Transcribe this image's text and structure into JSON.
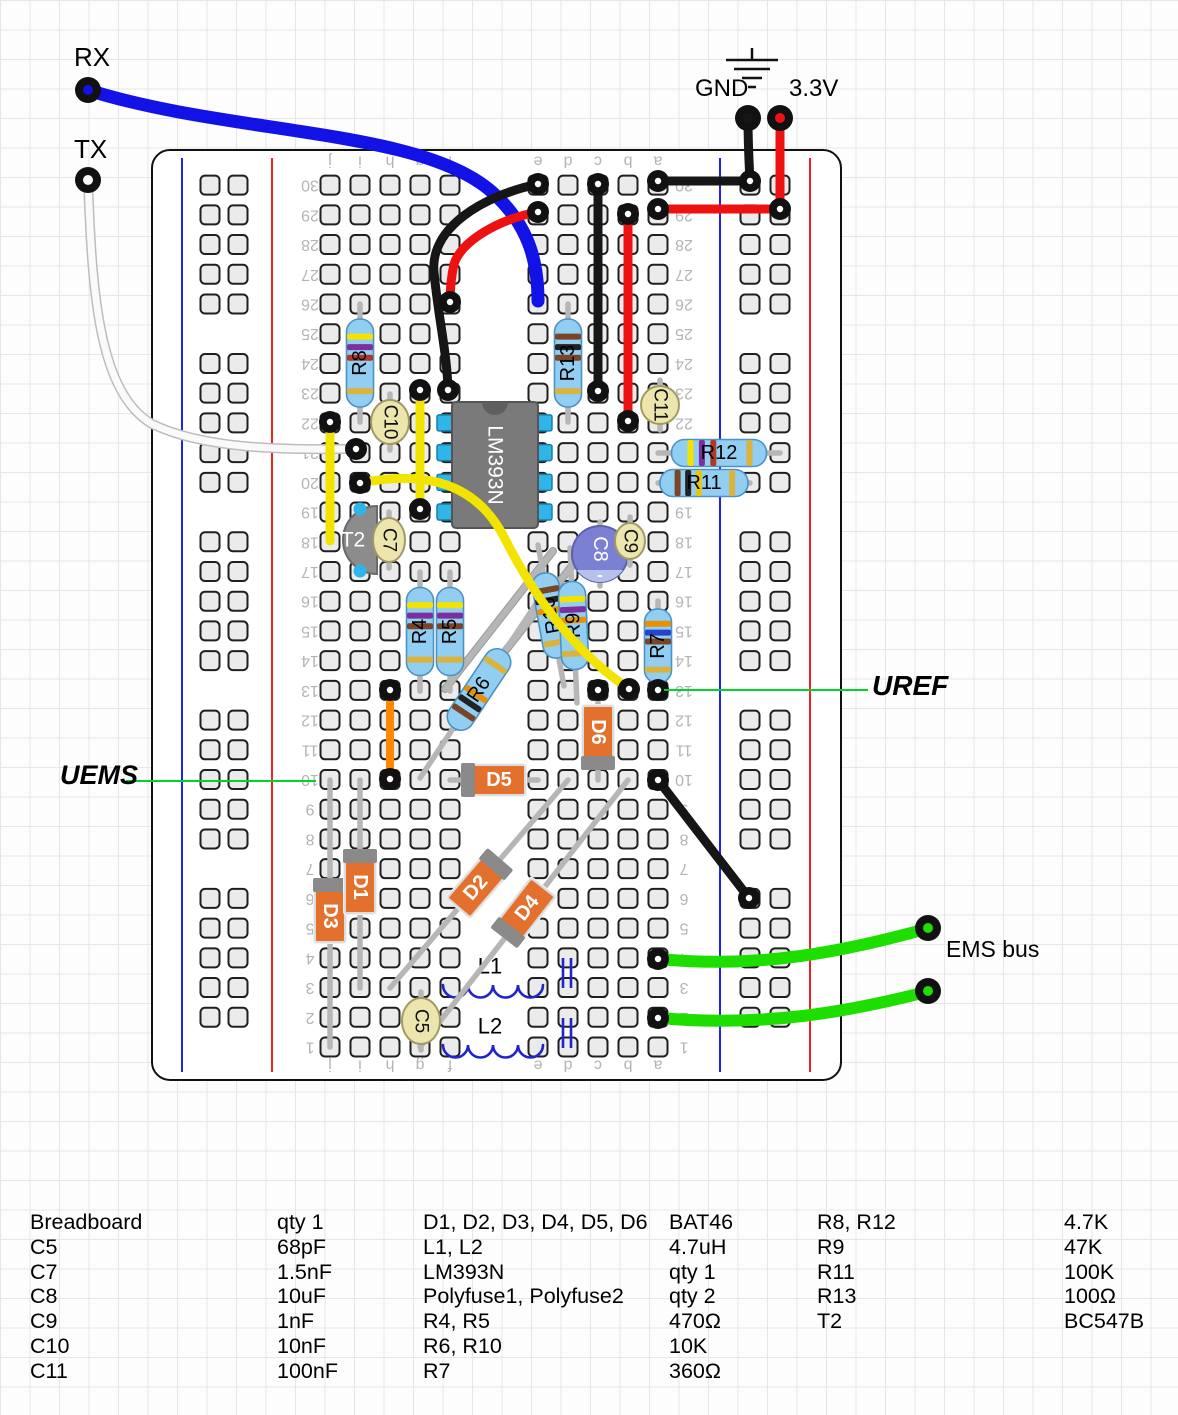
{
  "annotations": {
    "rx": "RX",
    "tx": "TX",
    "gnd": "GND",
    "v33": "3.3V",
    "uref": "UREF",
    "uems": "UEMS",
    "ems_bus": "EMS bus"
  },
  "board": {
    "x": 152,
    "y": 150,
    "w": 689,
    "h": 930,
    "rows": 30,
    "col_letters": [
      "j",
      "i",
      "h",
      "g",
      "f",
      "e",
      "d",
      "c",
      "b",
      "a"
    ],
    "col_x": [
      330,
      360,
      390,
      420,
      450,
      538,
      568,
      598,
      628,
      658
    ],
    "row_y0": 1047,
    "row_pitch": 29.72,
    "num_x_left": 310,
    "num_x_right": 684,
    "letters_y_top": 161,
    "letters_y_bottom": 1065,
    "rails": {
      "left": {
        "blue_x": 182,
        "red_x": 272,
        "hole_x": [
          210,
          238
        ]
      },
      "right": {
        "blue_x": 720,
        "red_x": 810,
        "hole_x": [
          750,
          780
        ]
      }
    },
    "hole": {
      "size": 19,
      "fill": "#ebebeb",
      "stroke": "#1f1f1f"
    },
    "label_color": "#b4b4b4"
  },
  "colors": {
    "rail_blue": "#2222ee",
    "rail_red": "#ee2222",
    "lead": "#b6b6b6",
    "resistor_body": "#92cdf2",
    "resistor_stroke": "#4b93c4",
    "diode_body": "#e4702d",
    "diode_stroke": "#dcdcdc",
    "diode_band": "#8a8a8a",
    "disc_cap": "#ece6ae",
    "disc_cap_stroke": "#a19a62",
    "elec_cap": "#7b80d2",
    "elec_cap_stroke": "#5c60b0",
    "elec_cap_stripe": "#b7c0ea",
    "ic_body": "#7a7a7a",
    "ic_stroke": "#555555",
    "ic_notch": "#5f5f5f",
    "ic_pin": "#2fb5e8",
    "ic_pin_stroke": "#1580aa",
    "transistor": "#8c8c8c",
    "transistor_stroke": "#6a6a6a",
    "inductor": "#2323cc",
    "annotation_green": "#00d42a",
    "ring": "#111111",
    "wire_map": {
      "blue": "#1212e6",
      "red": "#ee1111",
      "black": "#161616",
      "yellow": "#f2e400",
      "orange": "#ff8800",
      "green": "#1ede00",
      "white": "#fafafa"
    }
  },
  "components": [
    {
      "type": "polyfuse",
      "label": "Polyfuse1",
      "x1": 553,
      "y1": 551,
      "x2": 445,
      "y2": 689
    },
    {
      "type": "polyfuse",
      "label": "Polyfuse2",
      "x1": 571,
      "y1": 567,
      "x2": 463,
      "y2": 705
    },
    {
      "type": "inductor",
      "label": "L1",
      "x": 443,
      "y": 985,
      "w": 100,
      "lx": 490,
      "ly": 966
    },
    {
      "type": "inductor",
      "label": "L2",
      "x": 443,
      "y": 1045,
      "w": 100,
      "lx": 490,
      "ly": 1026
    },
    {
      "type": "diode",
      "label": "D3",
      "x1": 330,
      "y1": 780,
      "x2": 330,
      "y2": 1047,
      "cx": 330,
      "cy": 911,
      "bandStart": true
    },
    {
      "type": "diode",
      "label": "D1",
      "x1": 360,
      "y1": 780,
      "x2": 360,
      "y2": 988,
      "cx": 360,
      "cy": 882,
      "bandStart": true
    },
    {
      "type": "diode",
      "label": "D2",
      "x1": 390,
      "y1": 988,
      "x2": 568,
      "y2": 780,
      "cx": 479,
      "cy": 884,
      "bandStart": false
    },
    {
      "type": "diode",
      "label": "D4",
      "x1": 420,
      "y1": 1047,
      "x2": 628,
      "y2": 780,
      "cx": 524,
      "cy": 912,
      "bandStart": true
    },
    {
      "type": "diode",
      "label": "D5",
      "x1": 450,
      "y1": 780,
      "x2": 538,
      "y2": 780,
      "cx": 494,
      "cy": 780,
      "bandStart": true
    },
    {
      "type": "diode",
      "label": "D6",
      "x1": 598,
      "y1": 691,
      "x2": 598,
      "y2": 780,
      "cx": 598,
      "cy": 737,
      "bandStart": false
    },
    {
      "type": "transistor",
      "label": "T2",
      "cx": 355,
      "cy": 540
    },
    {
      "type": "resistor",
      "label": "R8",
      "x1": 360,
      "y1": 304,
      "x2": 360,
      "y2": 422,
      "bl": 88,
      "flip": true,
      "bands": [
        "#f2e400",
        "#7d2f9e",
        "#b03828"
      ]
    },
    {
      "type": "resistor",
      "label": "R13",
      "x1": 568,
      "y1": 304,
      "x2": 568,
      "y2": 422,
      "bl": 88,
      "flip": true,
      "bands": [
        "#7a4426",
        "#222222",
        "#7a4426"
      ]
    },
    {
      "type": "resistor",
      "label": "R12",
      "x1": 658,
      "y1": 453,
      "x2": 780,
      "y2": 453,
      "bl": 95,
      "flip": false,
      "bands": [
        "#f2e400",
        "#7d2f9e",
        "#b03828"
      ]
    },
    {
      "type": "resistor",
      "label": "R11",
      "x1": 658,
      "y1": 483,
      "x2": 750,
      "y2": 483,
      "bl": 88,
      "flip": false,
      "bands": [
        "#7a4426",
        "#222222",
        "#e8c800"
      ]
    },
    {
      "type": "resistor",
      "label": "R4",
      "x1": 420,
      "y1": 572,
      "x2": 420,
      "y2": 691,
      "bl": 88,
      "flip": true,
      "bands": [
        "#f2e400",
        "#7d2f9e",
        "#7a4426"
      ]
    },
    {
      "type": "resistor",
      "label": "R5",
      "x1": 450,
      "y1": 572,
      "x2": 450,
      "y2": 691,
      "bl": 88,
      "flip": true,
      "bands": [
        "#f2e400",
        "#7d2f9e",
        "#7a4426"
      ]
    },
    {
      "type": "resistor",
      "label": "R6",
      "x1": 420,
      "y1": 778,
      "x2": 538,
      "y2": 601,
      "bl": 92,
      "flip": false,
      "bands": [
        "#7a4426",
        "#222222",
        "#e89000"
      ]
    },
    {
      "type": "resistor",
      "label": "R10",
      "x1": 538,
      "y1": 545,
      "x2": 564,
      "y2": 686,
      "bl": 86,
      "flip": true,
      "bands": [
        "#7a4426",
        "#222222",
        "#e89000"
      ]
    },
    {
      "type": "resistor",
      "label": "R9",
      "x1": 570,
      "y1": 548,
      "x2": 577,
      "y2": 703,
      "bl": 88,
      "flip": true,
      "bands": [
        "#f2e400",
        "#7d2f9e",
        "#e89000"
      ]
    },
    {
      "type": "resistor",
      "label": "R7",
      "x1": 658,
      "y1": 601,
      "x2": 658,
      "y2": 691,
      "bl": 74,
      "flip": true,
      "bands": [
        "#e89000",
        "#2244cc",
        "#7a4426"
      ]
    },
    {
      "type": "ic",
      "label": "LM393N",
      "x": 452,
      "y": 402,
      "w": 86,
      "h": 126,
      "pin_rows": [
        19,
        20,
        21,
        22
      ]
    },
    {
      "type": "elec_cap",
      "label": "C8",
      "cx": 600,
      "cy": 554,
      "r": 28,
      "minus": "-"
    },
    {
      "type": "disc_cap",
      "label": "C10",
      "cx": 390,
      "cy": 422,
      "rx": 19,
      "ry": 22
    },
    {
      "type": "disc_cap",
      "label": "C7",
      "cx": 389,
      "cy": 540,
      "rx": 16,
      "ry": 22
    },
    {
      "type": "disc_cap",
      "label": "C9",
      "cx": 630,
      "cy": 541,
      "rx": 15,
      "ry": 18
    },
    {
      "type": "disc_cap",
      "label": "C11",
      "cx": 660,
      "cy": 405,
      "rx": 19,
      "ry": 19
    },
    {
      "type": "disc_cap",
      "label": "C5",
      "cx": 421,
      "cy": 1021,
      "rx": 19,
      "ry": 23
    }
  ],
  "wires": [
    {
      "name": "wire-rx-blue",
      "color": "blue",
      "w": 13,
      "d": "M88,90 C230,135 420,128 492,192 C528,224 538,260 538,301",
      "rings": []
    },
    {
      "name": "wire-tx-white",
      "color": "white",
      "w": 7,
      "d": "M88,180 C92,290 98,392 152,424 C210,452 300,449 356,449",
      "rings": [
        [
          356,
          449
        ]
      ]
    },
    {
      "name": "wire-gnd-drop",
      "color": "black",
      "w": 9,
      "d": "M748,118 C748,140 749,162 750,181",
      "rings": []
    },
    {
      "name": "wire-a30-rail",
      "color": "black",
      "w": 9,
      "d": "M658,181 L750,181",
      "rings": [
        [
          658,
          181
        ],
        [
          750,
          181
        ]
      ]
    },
    {
      "name": "wire-33v-drop",
      "color": "red",
      "w": 9,
      "d": "M780,118 L780,209",
      "rings": []
    },
    {
      "name": "wire-a29-rail",
      "color": "red",
      "w": 9,
      "d": "M658,209 L780,209",
      "rings": [
        [
          658,
          209
        ],
        [
          780,
          209
        ]
      ]
    },
    {
      "name": "wire-e30-f23",
      "color": "black",
      "w": 9,
      "d": "M538,184 C482,196 430,228 434,272 C438,316 447,352 448,390",
      "rings": [
        [
          538,
          184
        ],
        [
          448,
          390
        ]
      ]
    },
    {
      "name": "wire-e29-f26",
      "color": "red",
      "w": 9,
      "d": "M538,212 C500,219 462,240 454,264 C451,278 450,288 450,302",
      "rings": [
        [
          538,
          212
        ],
        [
          450,
          302
        ]
      ]
    },
    {
      "name": "wire-c30-c23",
      "color": "black",
      "w": 9,
      "d": "M598,184 L598,391",
      "rings": [
        [
          598,
          184
        ],
        [
          598,
          391
        ]
      ]
    },
    {
      "name": "wire-b29-b22",
      "color": "red",
      "w": 9,
      "d": "M628,214 L628,421",
      "rings": [
        [
          628,
          214
        ],
        [
          628,
          421
        ]
      ]
    },
    {
      "name": "wire-j22-j18",
      "color": "yellow",
      "w": 9,
      "d": "M330,422 L330,541",
      "rings": [
        [
          330,
          422
        ]
      ]
    },
    {
      "name": "wire-g23-g19",
      "color": "yellow",
      "w": 9,
      "d": "M420,390 L420,509",
      "rings": [
        [
          420,
          390
        ],
        [
          420,
          509
        ]
      ]
    },
    {
      "name": "wire-i20-b13",
      "color": "yellow",
      "w": 9,
      "d": "M360,483 C432,469 478,487 504,537 C534,596 572,650 629,689",
      "rings": [
        [
          360,
          483
        ],
        [
          629,
          689
        ]
      ]
    },
    {
      "name": "wire-h13-h10",
      "color": "orange",
      "w": 8,
      "d": "M390,690 L390,779",
      "rings": [
        [
          390,
          690
        ],
        [
          390,
          779
        ]
      ]
    },
    {
      "name": "wire-a10-rail",
      "color": "black",
      "w": 9,
      "d": "M658,780 L749,898",
      "rings": [
        [
          658,
          780
        ],
        [
          749,
          898
        ]
      ]
    },
    {
      "name": "wire-ems-1",
      "color": "green",
      "w": 12,
      "d": "M659,959 C762,969 844,951 926,929",
      "rings": []
    },
    {
      "name": "wire-ems-2",
      "color": "green",
      "w": 12,
      "d": "M659,1018 C762,1027 844,1013 926,992",
      "rings": []
    }
  ],
  "extra_rings": [
    [
      658,
      690
    ],
    [
      598,
      690
    ],
    [
      658,
      959
    ],
    [
      658,
      1018
    ]
  ],
  "pins": [
    {
      "name": "rx-pin",
      "x": 88,
      "y": 90,
      "c": "blue"
    },
    {
      "name": "tx-pin",
      "x": 88,
      "y": 180,
      "c": "white"
    },
    {
      "name": "gnd-pin",
      "x": 748,
      "y": 118,
      "c": "black"
    },
    {
      "name": "v33-pin",
      "x": 780,
      "y": 118,
      "c": "red"
    },
    {
      "name": "ems-pin-1",
      "x": 928,
      "y": 928,
      "c": "green"
    },
    {
      "name": "ems-pin-2",
      "x": 928,
      "y": 991,
      "c": "green"
    }
  ],
  "ground_symbol": {
    "x": 752,
    "stem_y1": 48,
    "stem_y2": 60,
    "lines": [
      [
        726,
        778,
        60
      ],
      [
        734,
        770,
        69
      ],
      [
        742,
        762,
        78
      ],
      [
        748,
        756,
        87
      ]
    ]
  },
  "annotation_lines": [
    {
      "name": "uems-line",
      "x1": 126,
      "y1": 781,
      "x2": 316,
      "y2": 781
    },
    {
      "name": "uref-line",
      "x1": 664,
      "y1": 690,
      "x2": 868,
      "y2": 690
    }
  ],
  "parts_list": {
    "top": 1212,
    "pitch": 24.8,
    "columns": [
      {
        "x": 30,
        "rows": [
          "Breadboard",
          "C5",
          "C7",
          "C8",
          "C9",
          "C10",
          "C11"
        ]
      },
      {
        "x": 277,
        "rows": [
          "qty 1",
          "68pF",
          "1.5nF",
          "10uF",
          "1nF",
          "10nF",
          "100nF"
        ]
      },
      {
        "x": 423,
        "rows": [
          "D1, D2, D3, D4, D5, D6",
          "L1, L2",
          "LM393N",
          "Polyfuse1, Polyfuse2",
          "R4, R5",
          "R6, R10",
          "R7"
        ]
      },
      {
        "x": 669,
        "rows": [
          "BAT46",
          "4.7uH",
          "qty 1",
          "qty 2",
          "470Ω",
          "10K",
          "360Ω"
        ]
      },
      {
        "x": 817,
        "rows": [
          "R8, R12",
          "R9",
          "R11",
          "R13",
          "T2"
        ]
      },
      {
        "x": 1064,
        "rows": [
          "4.7K",
          "47K",
          "100K",
          "100Ω",
          "BC547B"
        ]
      }
    ]
  }
}
